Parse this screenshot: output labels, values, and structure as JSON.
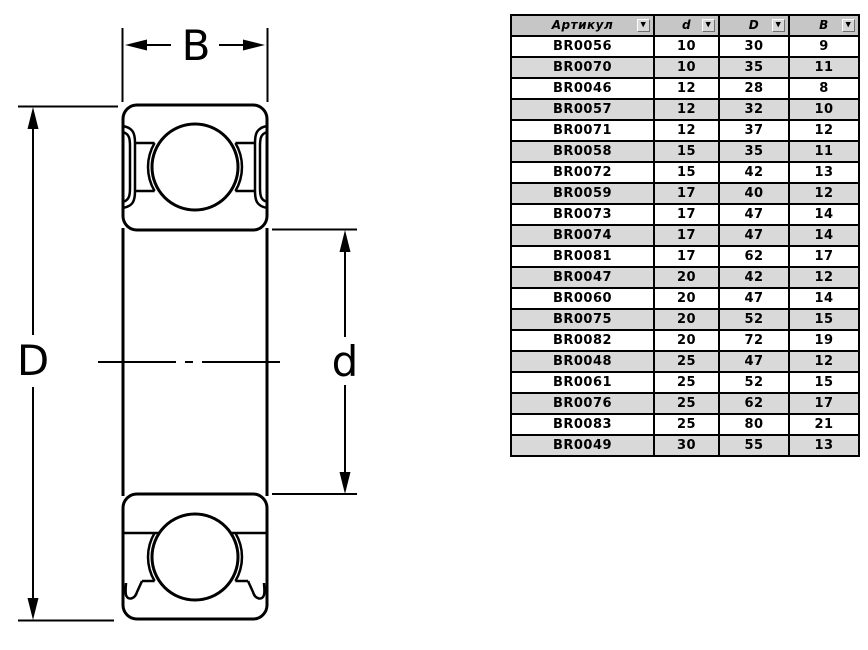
{
  "drawing": {
    "description": "ball bearing cross-section",
    "line_color": "#000000",
    "labels": {
      "width": "B",
      "outer_diameter": "D",
      "inner_diameter": "d"
    }
  },
  "table": {
    "header_bg": "#c6c6c6",
    "row_alt_bg": "#d9d9d9",
    "filter_icon": "▼",
    "columns": [
      {
        "label": "Артикул"
      },
      {
        "label": "d"
      },
      {
        "label": "D"
      },
      {
        "label": "B"
      }
    ],
    "rows": [
      [
        "BR0056",
        "10",
        "30",
        "9"
      ],
      [
        "BR0070",
        "10",
        "35",
        "11"
      ],
      [
        "BR0046",
        "12",
        "28",
        "8"
      ],
      [
        "BR0057",
        "12",
        "32",
        "10"
      ],
      [
        "BR0071",
        "12",
        "37",
        "12"
      ],
      [
        "BR0058",
        "15",
        "35",
        "11"
      ],
      [
        "BR0072",
        "15",
        "42",
        "13"
      ],
      [
        "BR0059",
        "17",
        "40",
        "12"
      ],
      [
        "BR0073",
        "17",
        "47",
        "14"
      ],
      [
        "BR0074",
        "17",
        "47",
        "14"
      ],
      [
        "BR0081",
        "17",
        "62",
        "17"
      ],
      [
        "BR0047",
        "20",
        "42",
        "12"
      ],
      [
        "BR0060",
        "20",
        "47",
        "14"
      ],
      [
        "BR0075",
        "20",
        "52",
        "15"
      ],
      [
        "BR0082",
        "20",
        "72",
        "19"
      ],
      [
        "BR0048",
        "25",
        "47",
        "12"
      ],
      [
        "BR0061",
        "25",
        "52",
        "15"
      ],
      [
        "BR0076",
        "25",
        "62",
        "17"
      ],
      [
        "BR0083",
        "25",
        "80",
        "21"
      ],
      [
        "BR0049",
        "30",
        "55",
        "13"
      ]
    ]
  }
}
